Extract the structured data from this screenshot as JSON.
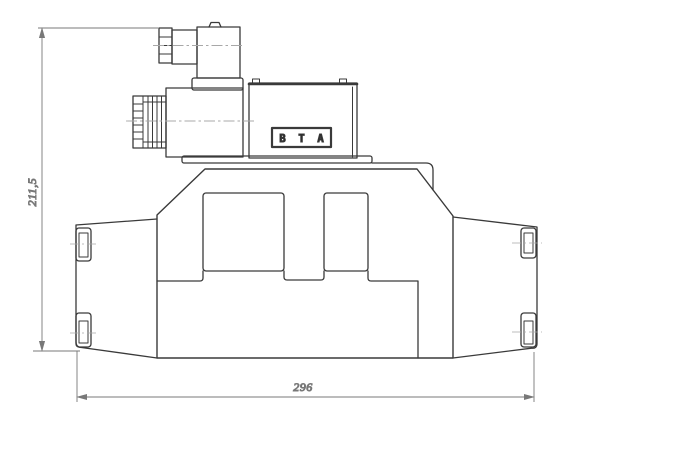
{
  "dimensions": {
    "height_label": "211,5",
    "width_label": "296"
  },
  "port_labels": {
    "b": "B",
    "t": "T",
    "a": "A"
  },
  "colors": {
    "background": "#ffffff",
    "outline": "#3a3a3a",
    "dimension": "#787878",
    "centerline": "#a8a8a8",
    "label_text": "#4f4f4f",
    "port_text": "#222222"
  }
}
